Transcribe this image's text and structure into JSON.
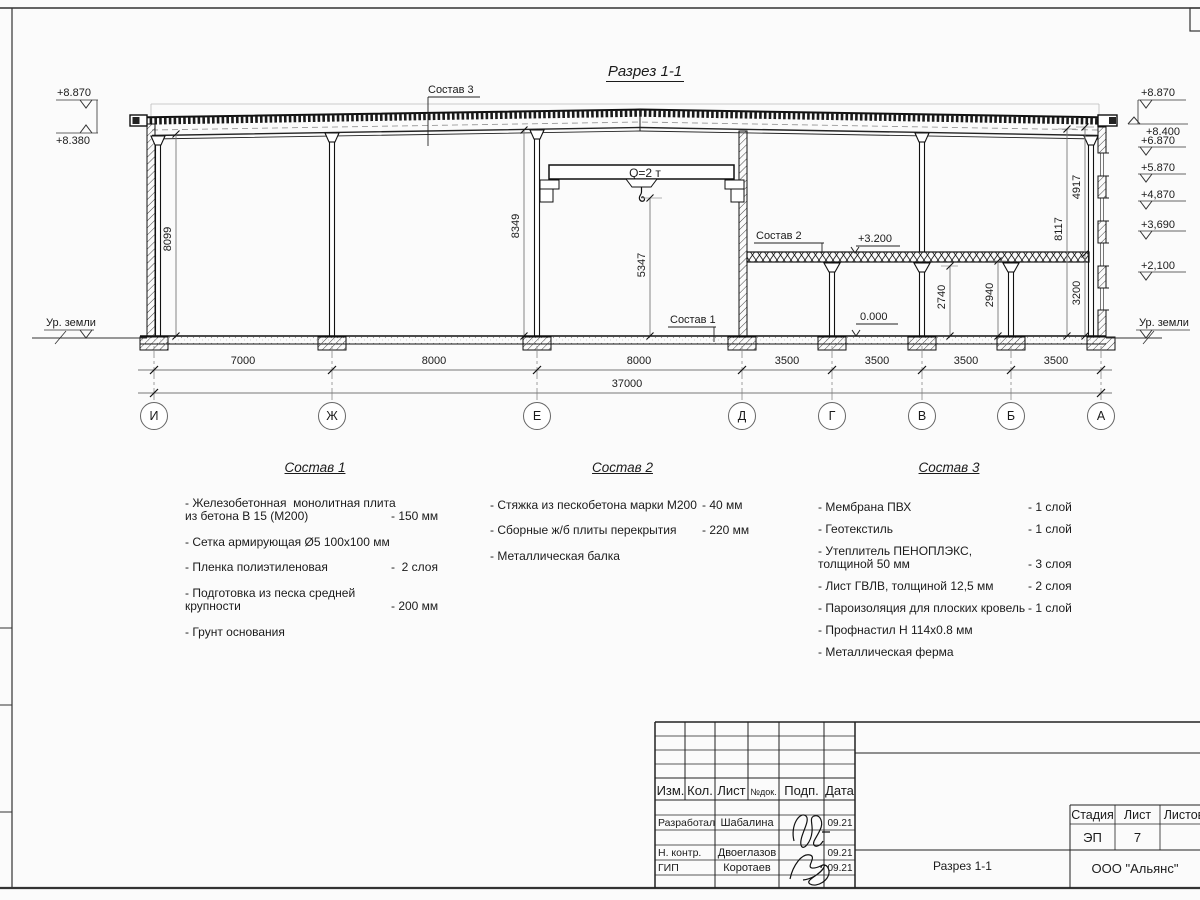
{
  "drawing": {
    "title": "Разрез 1-1",
    "crane_label": "Q=2 т",
    "callout_sostav1": "Состав 1",
    "callout_sostav2": "Состав 2",
    "callout_sostav3": "Состав 3",
    "level_slab": "+3.200",
    "level_zero": "0.000",
    "elev": {
      "l1": "+8.870",
      "l2": "+8.380",
      "l3": "Ур. земли",
      "r1": "+8.870",
      "r2": "+8.400",
      "r3": "+6.870",
      "r4": "+5.870",
      "r5": "+4,870",
      "r6": "+3,690",
      "r7": "+2,100",
      "r8": "Ур. земли"
    },
    "vdim": {
      "v8099": "8099",
      "v8349": "8349",
      "v5347": "5347",
      "v2740": "2740",
      "v2940": "2940",
      "v3200": "3200",
      "v8117": "8117",
      "v4917": "4917"
    },
    "hdim": [
      "7000",
      "8000",
      "8000",
      "3500",
      "3500",
      "3500",
      "3500"
    ],
    "total": "37000",
    "axes": [
      "И",
      "Ж",
      "Е",
      "Д",
      "Г",
      "В",
      "Б",
      "А"
    ]
  },
  "lists": {
    "s1": {
      "title": "Состав 1",
      "items": [
        {
          "name": "- Железобетонная  монолитная плита\nиз бетона В 15 (М200)",
          "value": "- 150 мм"
        },
        {
          "name": "- Сетка армирующая Ø5 100x100 мм",
          "value": ""
        },
        {
          "name": "- Пленка полиэтиленовая",
          "value": "-  2 слоя"
        },
        {
          "name": "- Подготовка из песка средней\nкрупности",
          "value": "- 200 мм"
        },
        {
          "name": "- Грунт основания",
          "value": ""
        }
      ]
    },
    "s2": {
      "title": "Состав 2",
      "items": [
        {
          "name": "- Стяжка из пескобетона марки М200",
          "value": "- 40 мм"
        },
        {
          "name": "- Сборные ж/б плиты перекрытия",
          "value": "- 220 мм"
        },
        {
          "name": "- Металлическая балка",
          "value": ""
        }
      ]
    },
    "s3": {
      "title": "Состав 3",
      "items": [
        {
          "name": "- Мембрана ПВХ",
          "value": "- 1 слой"
        },
        {
          "name": "- Геотекстиль",
          "value": "- 1 слой"
        },
        {
          "name": "- Утеплитель ПЕНОПЛЭКС,\nтолщиной 50 мм",
          "value": "- 3 слоя"
        },
        {
          "name": "- Лист ГВЛВ, толщиной 12,5 мм",
          "value": "- 2 слоя"
        },
        {
          "name": "- Пароизоляция для плоских кровель",
          "value": "- 1 слой"
        },
        {
          "name": "- Профнастил Н 114х0.8 мм",
          "value": ""
        },
        {
          "name": "- Металлическая ферма",
          "value": ""
        }
      ]
    }
  },
  "titleblock": {
    "headers": {
      "izm": "Изм.",
      "kol": "Кол.",
      "list": "Лист",
      "ndok": "№док.",
      "podp": "Подп.",
      "data": "Дата"
    },
    "rows": [
      {
        "role": "Разработал",
        "name": "Шабалина",
        "date": "09.21"
      },
      {
        "role": "Н. контр.",
        "name": "Двоеглазов",
        "date": "09.21"
      },
      {
        "role": "ГИП",
        "name": "Коротаев",
        "date": "09.21"
      }
    ],
    "stage_headers": {
      "stadia": "Стадия",
      "list": "Лист",
      "listov": "Листов"
    },
    "stage": "ЭП",
    "sheet_no": "7",
    "doc_name": "Разрез 1-1",
    "company": "ООО \"Альянс\""
  },
  "colors": {
    "ink": "#1a1a1a",
    "dim_line": "#777777",
    "paper": "#fbfbfb"
  }
}
